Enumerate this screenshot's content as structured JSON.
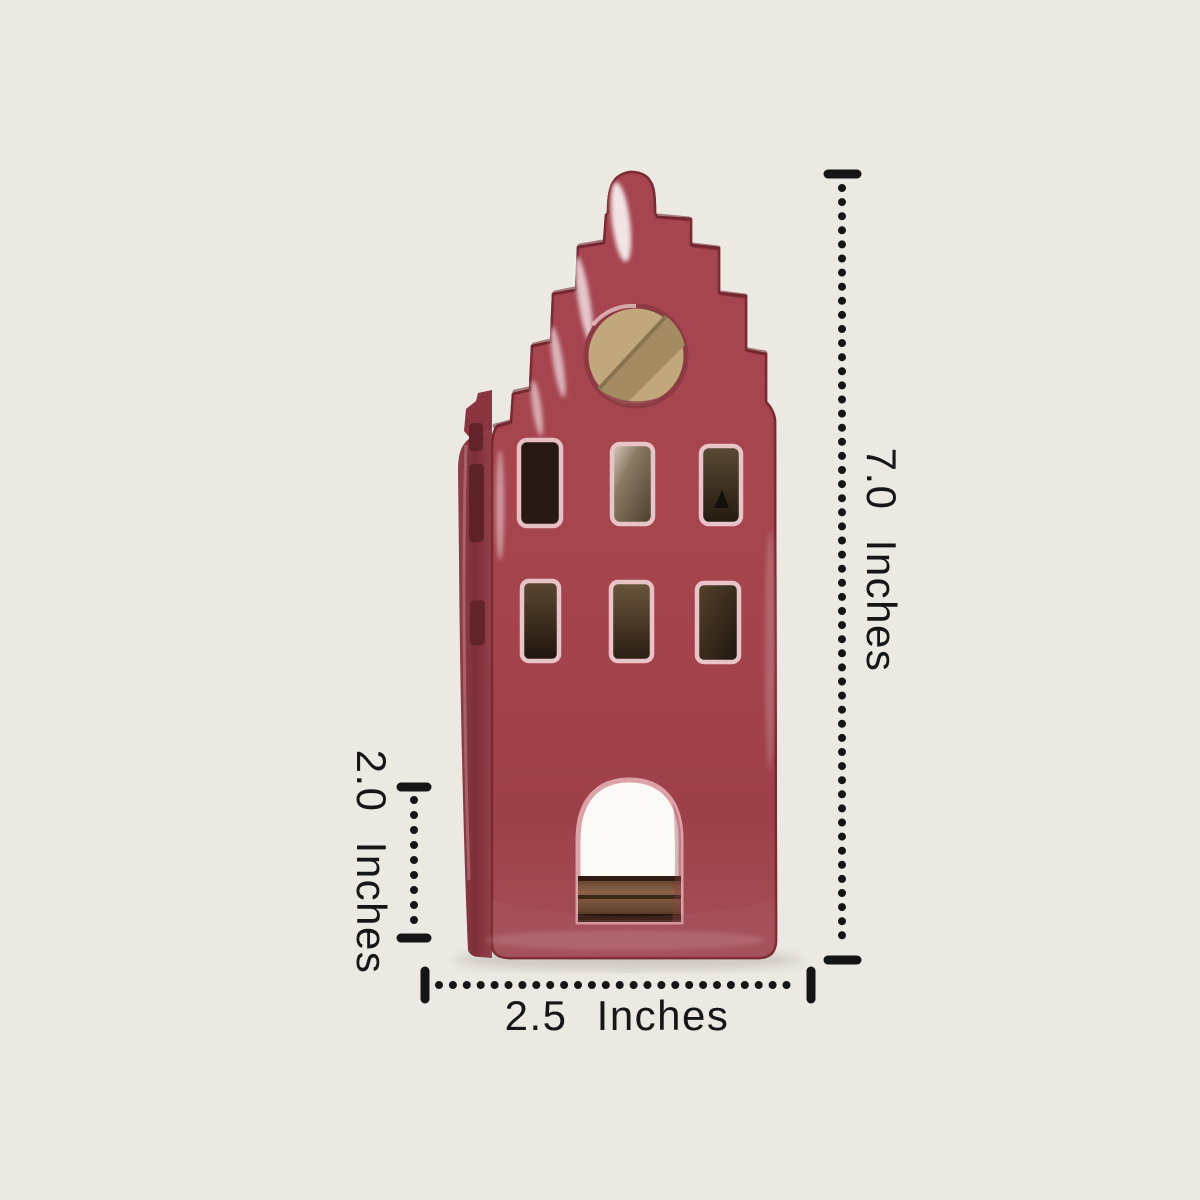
{
  "scene": {
    "description": "Product dimension photo of a red stepped-gable ceramic canal house tealight holder on a cream background",
    "background_color": "#ECE9E3"
  },
  "annotations": {
    "height": {
      "label": "7.0 Inches",
      "value": "7.0",
      "unit": "Inches",
      "orientation": "vertical-right"
    },
    "lower_section_height": {
      "label": "2.0 Inches",
      "value": "2.0",
      "unit": "Inches",
      "orientation": "vertical-left"
    },
    "width": {
      "label": "2.5 Inches",
      "value": "2.5",
      "unit": "Inches",
      "orientation": "horizontal-bottom"
    }
  },
  "colors": {
    "background": "#ECE9E3",
    "annotation_ink": "#161616",
    "house_glaze_red": "#A7454E",
    "house_side_red": "#82313A",
    "house_edge_dark": "#6E232D",
    "window_rim_pink": "#E9C4C6",
    "window_interior_dark": "#241711",
    "window_interior_tan": "#6F604D",
    "round_hole_interior": "#C2A77C",
    "door_interior_white": "#FBFAF6",
    "door_wood_brown": "#7A5136"
  }
}
